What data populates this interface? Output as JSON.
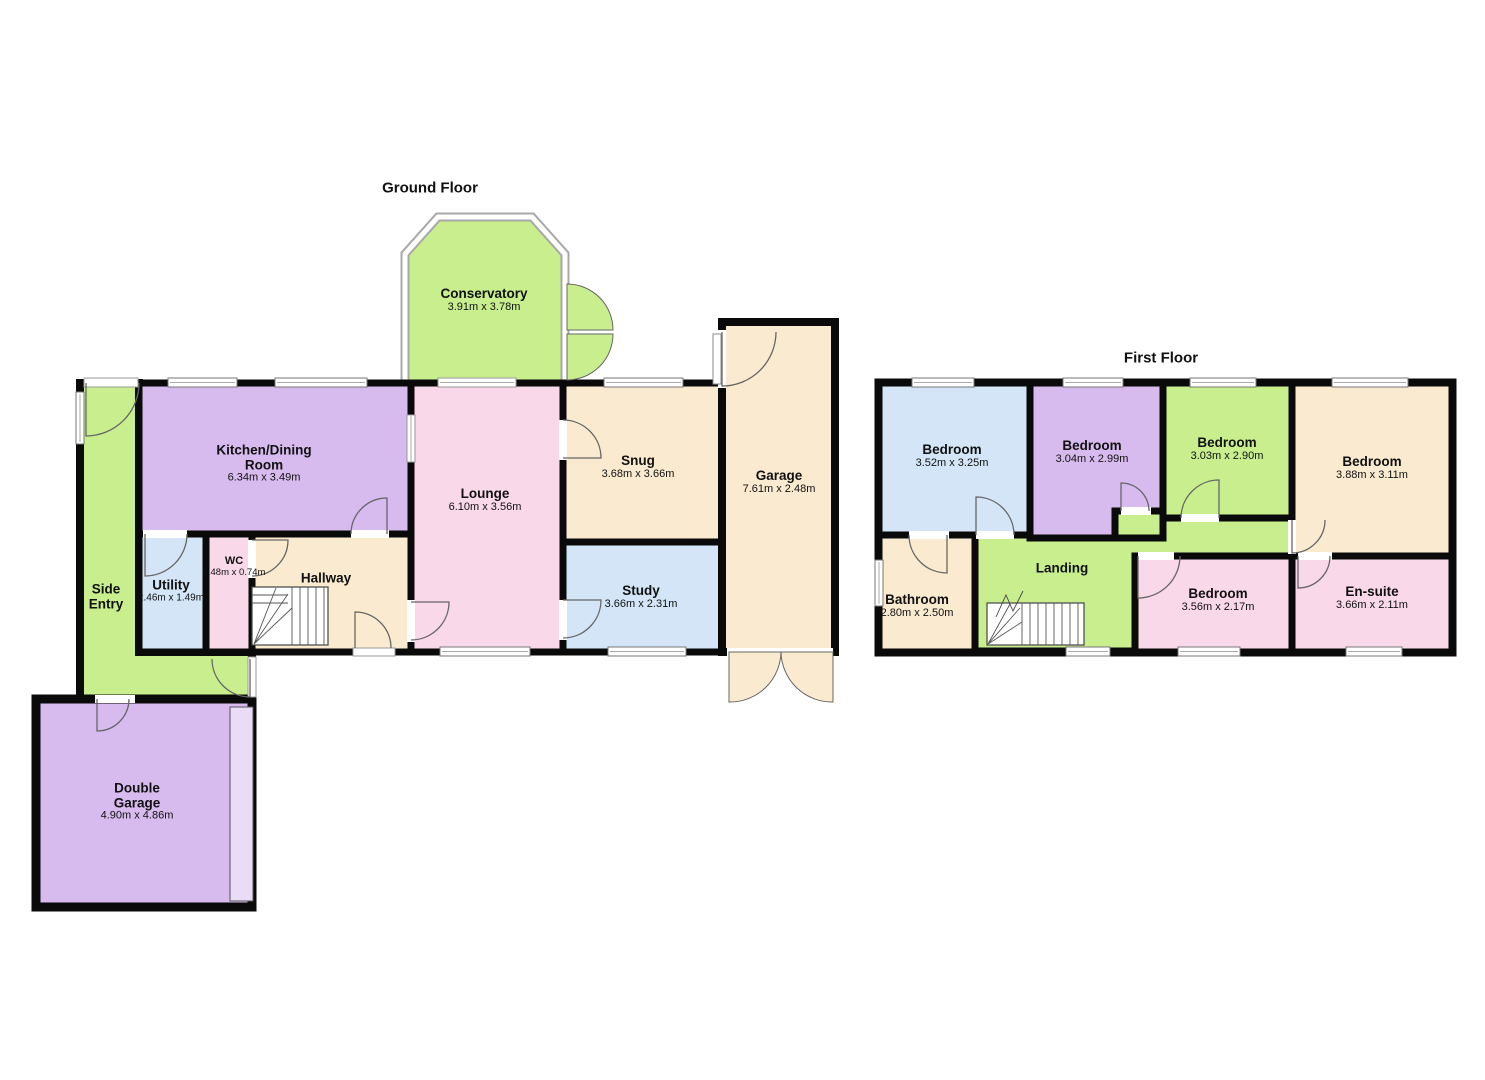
{
  "palette": {
    "green": "#c8ee8e",
    "purple": "#d8bbee",
    "pink": "#f9d8e9",
    "beige": "#faeacf",
    "blue": "#d3e5f6",
    "wall": "#0a0a0a",
    "garage_door_panel": "#e9dcf6"
  },
  "ground_floor": {
    "title": "Ground Floor",
    "rooms": {
      "conservatory": {
        "name": "Conservatory",
        "dims": "3.91m x 3.78m"
      },
      "kitchen_dining": {
        "name": "Kitchen/Dining Room",
        "dims": "6.34m x 3.49m"
      },
      "lounge": {
        "name": "Lounge",
        "dims": "6.10m x 3.56m"
      },
      "snug": {
        "name": "Snug",
        "dims": "3.68m x 3.66m"
      },
      "study": {
        "name": "Study",
        "dims": "3.66m x 2.31m"
      },
      "garage": {
        "name": "Garage",
        "dims": "7.61m x 2.48m"
      },
      "hallway": {
        "name": "Hallway"
      },
      "wc": {
        "name": "WC",
        "dims": "2.48m x 0.74m"
      },
      "utility": {
        "name": "Utility",
        "dims": "2.46m x 1.49m"
      },
      "side_entry": {
        "name": "Side Entry"
      },
      "double_garage": {
        "name": "Double Garage",
        "dims": "4.90m x 4.86m"
      }
    }
  },
  "first_floor": {
    "title": "First Floor",
    "rooms": {
      "bedroom1": {
        "name": "Bedroom",
        "dims": "3.52m x 3.25m"
      },
      "bedroom2": {
        "name": "Bedroom",
        "dims": "3.04m x 2.99m"
      },
      "bedroom3": {
        "name": "Bedroom",
        "dims": "3.03m x 2.90m"
      },
      "bedroom4": {
        "name": "Bedroom",
        "dims": "3.88m x 3.11m"
      },
      "bathroom": {
        "name": "Bathroom",
        "dims": "2.80m x 2.50m"
      },
      "landing": {
        "name": "Landing"
      },
      "bedroom5": {
        "name": "Bedroom",
        "dims": "3.56m x 2.17m"
      },
      "ensuite": {
        "name": "En-suite",
        "dims": "3.66m x 2.11m"
      }
    }
  }
}
